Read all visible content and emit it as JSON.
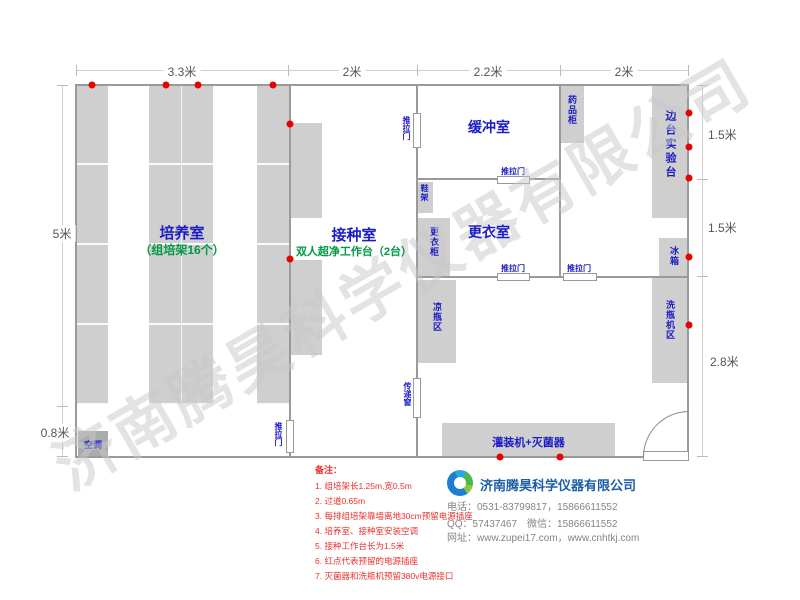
{
  "watermark": "济南腾昊科学仪器有限公司",
  "dims": {
    "top1": "3.3米",
    "top2": "2米",
    "top3": "2.2米",
    "top4": "2米",
    "left1": "5米",
    "left2": "0.8米",
    "right1": "1.5米",
    "right2": "1.5米",
    "right3": "2.8米"
  },
  "rooms": {
    "cultivation": {
      "name": "培养室",
      "sub": "（组培架16个）"
    },
    "inoculation": {
      "name": "接种室",
      "sub": "双人超净工作台（2台）"
    },
    "buffer": {
      "name": "缓冲室"
    },
    "changing": {
      "name": "更衣室"
    }
  },
  "labels": {
    "ac": "空调",
    "sliding_door": "推拉门",
    "pass_window": "传递窗",
    "shoe_rack": "鞋架",
    "wardrobe": "更衣柜",
    "medicine_cabinet": "药品柜",
    "side_bench": "边台实验台",
    "fridge": "冰箱",
    "washer_area": "洗瓶机区",
    "cooling_area": "凉瓶区",
    "filling_machine": "灌装机+灭菌器"
  },
  "notes": {
    "title": "备注：",
    "items": [
      "1. 组培架长1.25m,宽0.5m",
      "2. 过道0.65m",
      "3. 每排组培架靠墙离地30cm预留电源插座",
      "4. 培养室、接种室安装空调",
      "5. 接种工作台长为1.5米",
      "6. 红点代表预留的电源插座",
      "7. 灭菌器和洗瓶机预留380v电源接口"
    ]
  },
  "company": {
    "name": "济南腾昊科学仪器有限公司",
    "phone": "电话：0531-83799817，15866611552",
    "qq": "QQ：57437467　微信：15866611552",
    "web": "网址：www.zupei17.com，www.cnhtkj.com"
  },
  "colors": {
    "accent_blue": "#1c1cc4",
    "accent_green": "#009a44",
    "note_red": "#e8312f",
    "brand_blue": "#1b5ea6",
    "wall_gray": "#9a9a9a",
    "furniture_gray": "#cfcfcf",
    "socket_dot_red": "#e90000"
  }
}
